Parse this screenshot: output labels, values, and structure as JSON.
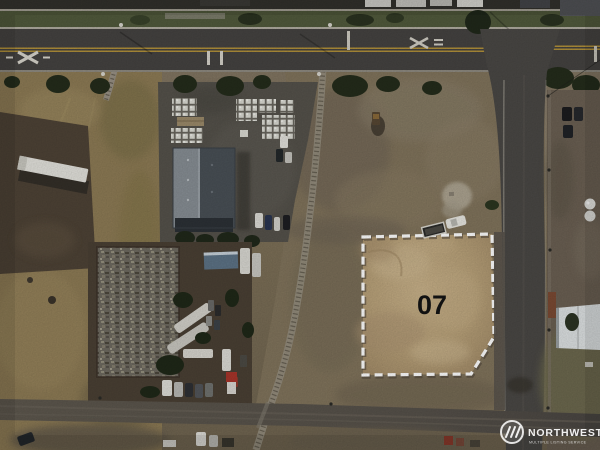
{
  "photo": {
    "kind": "aerial-drone-real-estate-photo",
    "lot": {
      "number": "07",
      "boundary_color": "#ffffff",
      "boundary_style": "dashed",
      "label_color": "#141414",
      "ground_color": "#b8a179"
    },
    "watermark": {
      "brand": "NORTHWEST",
      "tagline": "MULTIPLE LISTING SERVICE",
      "icon": "nwmls-circle-m-icon",
      "text_color": "#ffffff"
    },
    "scene_features": [
      "highway-with-railroad-crossing-markings",
      "cross-street-intersection",
      "curved-railroad-track",
      "gray-gabled-warehouse",
      "pallet-storage-yard",
      "scrap-salvage-yard-with-rvs",
      "white-semi-trailer",
      "vacant-dirt-lot-07",
      "gravel-road",
      "white-roof-house",
      "storage-tanks"
    ],
    "palette": {
      "asphalt": "#454341",
      "gravel_road": "#5b554c",
      "field": "#7e7158",
      "dry_grass": "#8d7b55",
      "tree_green": "#242c1b",
      "roof_light": "#878e94",
      "roof_dark": "#495056",
      "centerline_yellow": "#b2913a"
    }
  }
}
